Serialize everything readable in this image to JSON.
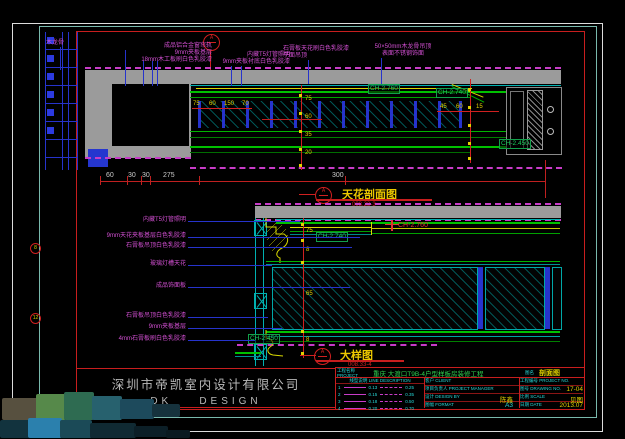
{
  "sheet": {
    "section_marker": "A",
    "upper": {
      "title": "天花剖面图",
      "note": "008.23-3",
      "bubble": "A",
      "ann1": "木龙骨",
      "ann2": [
        "成品铝合金窗帘轨",
        "9mm夹板基层",
        "18mm木工板刷白色乳胶漆"
      ],
      "ann3": [
        "内藏T5灯管照明",
        "9mm夹板衬底白色乳胶漆"
      ],
      "ann4": [
        "石膏板天花刷白色乳胶漆",
        "平面吊顶"
      ],
      "ann5": [
        "50×50mm木龙骨吊顶",
        "表面不锈钢饰面"
      ],
      "ch": [
        "CH-2.760",
        "CH-2.740",
        "CH-2.450"
      ],
      "dims_bottom": [
        "60",
        "30",
        "30",
        "275",
        "300"
      ],
      "dims_top": [
        "75",
        "60",
        "150",
        "70"
      ],
      "dims_right": [
        "45",
        "60",
        "15"
      ],
      "chain": [
        "75",
        "60",
        "35",
        "20"
      ]
    },
    "lower": {
      "title": "大样图",
      "note": "008.33-4",
      "bubble": "A",
      "ann": [
        "内藏T5灯管照明",
        "9mm天花夹板基层白色乳胶漆",
        "石膏板吊顶白色乳胶漆",
        "玻璃灯槽天花",
        "成品饰面板",
        "石膏板吊顶白色乳胶漆",
        "9mm夹板基层",
        "4mm石膏板刷白色乳胶漆"
      ],
      "keynotes": [
        "8",
        "12"
      ],
      "ch": [
        "CH-2.740",
        "CH-2.760",
        "CH-2.450"
      ],
      "chain": [
        "75",
        "8",
        "65",
        "8"
      ]
    }
  },
  "title_block": {
    "company": "深圳市帝凯室内设计有限公司",
    "brand": "DK    DESIGN",
    "project_label": "工程名称 PROJECT",
    "project_name": "重庆 大渡口T9B-4户型样板房装修工程",
    "drawing_label": "图名",
    "drawing_name": "剖面图",
    "legend_header": "线型说明 LINE DESCRIPTION",
    "legend": [
      {
        "no": "1",
        "w1": "0.13",
        "w2": "0.25"
      },
      {
        "no": "2",
        "w1": "0.15",
        "w2": "0.35"
      },
      {
        "no": "3",
        "w1": "0.18",
        "w2": "0.50"
      },
      {
        "no": "4",
        "w1": "0.20",
        "w2": "0.70"
      }
    ],
    "fields_left": [
      {
        "label": "客户 CLIENT",
        "value": ""
      },
      {
        "label": "项目负责人 PROJECT MANAGER",
        "value": ""
      },
      {
        "label": "设计 DESIGN BY",
        "value": "陈鑫"
      },
      {
        "label": "图幅 FORMAT",
        "value": "A3"
      }
    ],
    "fields_right": [
      {
        "label": "工程编号 PROJECT NO.",
        "value": ""
      },
      {
        "label": "图号 DRAWING NO.",
        "value": "17-04"
      },
      {
        "label": "比例 SCALE",
        "value": "见图"
      },
      {
        "label": "日期 DATE",
        "value": "2013.07"
      }
    ]
  },
  "colors": {
    "frame_red": "#c81e1e",
    "line_green": "#00c000",
    "line_cyan": "#00b0b0",
    "annotation_magenta": "#d24fd2",
    "dim_yellow": "#e0d000",
    "title_yellow": "#ecc800",
    "slab_grey": "#9b9b9b",
    "leader_blue": "#2633cc"
  }
}
